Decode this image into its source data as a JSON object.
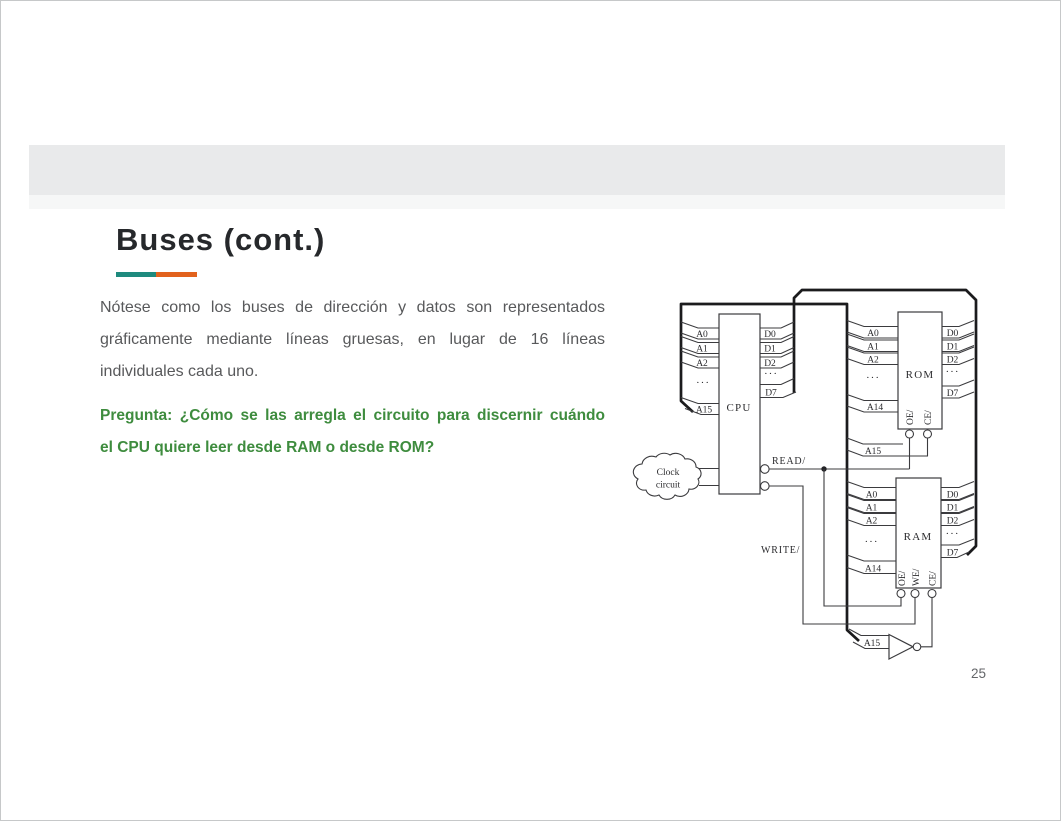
{
  "header": {
    "title": "Buses (cont.)"
  },
  "accent": {
    "teal": "#1e8a7e",
    "orange": "#e2621d",
    "band_gray": "#e9eaeb",
    "question_green": "#3e8c3e",
    "body_gray": "#58595b"
  },
  "body": {
    "lines": [
      "Nótese como los buses de dirección y datos son representados",
      "gráficamente mediante  líneas gruesas, en lugar de 16 líneas",
      "individuales cada uno."
    ]
  },
  "question": {
    "lines": [
      "Pregunta: ¿Cómo se las arregla el circuito para discernir cuándo",
      "el CPU quiere leer desde RAM o desde ROM?"
    ]
  },
  "diagram": {
    "cpu": {
      "label": "CPU",
      "addr": [
        "A0",
        "A1",
        "A2",
        "···",
        "A15"
      ],
      "data": [
        "D0",
        "D1",
        "D2",
        "···",
        "D7"
      ]
    },
    "rom": {
      "label": "ROM",
      "addr": [
        "A0",
        "A1",
        "A2",
        "···",
        "A14"
      ],
      "data": [
        "D0",
        "D1",
        "D2",
        "···",
        "D7"
      ],
      "ctrl": [
        "OE/",
        "CE/"
      ],
      "a15": "A15"
    },
    "ram": {
      "label": "RAM",
      "addr": [
        "A0",
        "A1",
        "A2",
        "···",
        "A14"
      ],
      "data": [
        "D0",
        "D1",
        "D2",
        "···",
        "D7"
      ],
      "ctrl": [
        "OE/",
        "WE/",
        "CE/"
      ]
    },
    "clock": {
      "line1": "Clock",
      "line2": "circuit"
    },
    "signals": {
      "read": "READ/",
      "write": "WRITE/",
      "inverter_input": "A15"
    }
  },
  "page": {
    "number": "25"
  }
}
